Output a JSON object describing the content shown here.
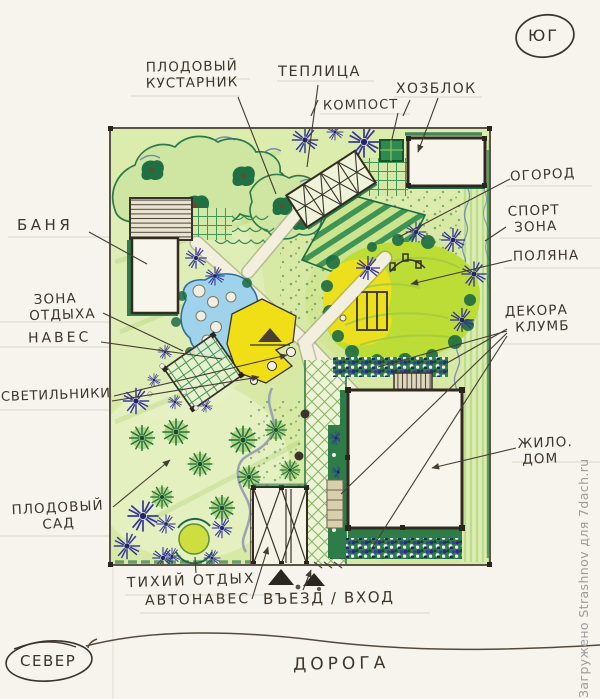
{
  "compass": {
    "south": "ЮГ",
    "north": "СЕВЕР"
  },
  "plan_labels": {
    "fruit_shrub": {
      "line1": "ПЛОДОВЫЙ",
      "line2": "КУСТАРНИК"
    },
    "greenhouse": "ТЕПЛИЦА",
    "shed": "ХОЗБЛОК",
    "compost": "КОМПОСТ",
    "vegetable_garden": "ОГОРОД",
    "sport_zone": {
      "line1": "СПОРТ",
      "line2": "ЗОНА"
    },
    "glade": "ПОЛЯНА",
    "bathhouse": "БАНЯ",
    "rest_zone": {
      "line1": "ЗОНА",
      "line2": "ОТДЫХА"
    },
    "canopy": "НАВЕС",
    "lamps": "СВЕТИЛЬНИКИ",
    "decorative_beds": {
      "line1": "ДЕКОРА",
      "line2": "КЛУМБ"
    },
    "dwelling_house": {
      "line1": "ЖИЛО.",
      "line2": "ДОМ"
    },
    "orchard": {
      "line1": "ПЛОДОВЫЙ",
      "line2": "САД"
    },
    "quiet_rest": "ТИХИЙ ОТДЫХ",
    "carport": "АВТОНАВЕС",
    "entrance": "ВЪЕЗД / ВХОД",
    "road": "ДОРОГА"
  },
  "watermark": {
    "credit": "Загружено Strashnov для 7dach.ru"
  },
  "colors": {
    "paper": "#f6f4ec",
    "lawn": "#d8e9a6",
    "meadow": "#bcdc36",
    "pond": "#9fd3ec",
    "patio": "#f0df17",
    "dark_green": "#1d6b44",
    "blue_plant": "#34349b",
    "ink": "#3e362b"
  }
}
